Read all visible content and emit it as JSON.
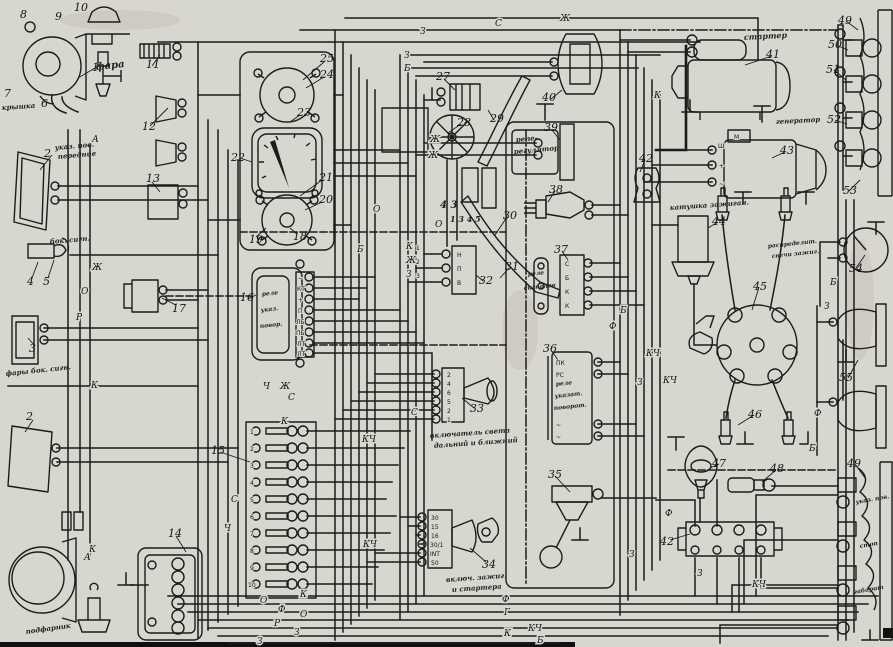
{
  "palette": {
    "paper": "#d7d6cf",
    "ink": "#1c1c1c"
  },
  "num": {
    "n1": "1",
    "n2": "2",
    "n3": "3",
    "n4": "4",
    "n5": "5",
    "n6": "6",
    "n7": "7",
    "n8": "8",
    "n9": "9",
    "n10": "10",
    "n11": "11",
    "n12": "12",
    "n13": "13",
    "n14": "14",
    "n15": "15",
    "n16": "16",
    "n17": "17",
    "n18": "18",
    "n19": "19",
    "n20": "20",
    "n21": "21",
    "n22": "22",
    "n23": "23",
    "n24": "24",
    "n25": "25",
    "n27": "27",
    "n28": "28",
    "n29": "29",
    "n30": "30",
    "n31": "31",
    "n32": "32",
    "n33": "33",
    "n34": "34",
    "n35": "35",
    "n36": "36",
    "n37": "37",
    "n38": "38",
    "n39": "39",
    "n40": "40",
    "n41": "41",
    "n42": "42",
    "n43": "43",
    "n44": "44",
    "n45": "45",
    "n46": "46",
    "n47": "47",
    "n48": "48",
    "n49": "49",
    "n50": "50",
    "n51": "51",
    "n52": "52",
    "n53": "53",
    "n54": "54",
    "n55": "55"
  },
  "fuse_numbers": [
    "1",
    "2",
    "3",
    "4",
    "5",
    "6",
    "7",
    "8",
    "9",
    "10"
  ],
  "wire_letters": {
    "a": "А",
    "b": "Б",
    "g": "Г",
    "zh": "Ж",
    "z": "З",
    "k": "К",
    "kch": "КЧ",
    "o": "О",
    "p": "П",
    "r": "Р",
    "s": "С",
    "f": "Ф",
    "ch": "Ч"
  },
  "terminals": {
    "t16": [
      "−",
      "КТ",
      "+",
      "П",
      "ЛБ",
      "ПБ",
      "ЛТ",
      "ЛТ"
    ],
    "t32": [
      "Н",
      "П",
      "В"
    ],
    "t33": [
      "2",
      "4",
      "6",
      "5",
      "2",
      "1"
    ],
    "t34": [
      "30",
      "15",
      "16",
      "30/1",
      "INT",
      "50"
    ],
    "t36": [
      "ПК",
      "РС",
      "~",
      "~"
    ],
    "t37": [
      "С",
      "Б",
      "К",
      "К"
    ],
    "t43": [
      "М",
      "Ш",
      "+",
      "~"
    ]
  },
  "annotations": {
    "fara": "фара",
    "kryshka": "крышка",
    "front1": "указ. пов.",
    "front2": "передние",
    "bok_note": "бок. сигн.",
    "bok_lamp": "фары бок. сигн.",
    "rele_ukaz1": "реле",
    "rele_ukaz2": "указ.",
    "rele_ukaz3": "повор.",
    "digits_a": "4 3",
    "digits_b": "1 3 4 5",
    "sw_light1": "включатель света",
    "sw_light2": "дальний и ближний",
    "ign1": "включ. зажиг.",
    "ign2": "и стартера",
    "rele_sign1": "реле",
    "rele_sign2": "сигналов",
    "rele_pov1": "реле",
    "rele_pov2": "указат.",
    "rele_pov3": "поворот.",
    "rele_reg1": "реле-",
    "rele_reg2": "регулятор",
    "starter": "стартер",
    "generator": "генератор",
    "coil": "катушка зажиган.",
    "raspred1": "распределит.",
    "raspred2": "свечи зажиг.",
    "podfarnik": "подфарник",
    "zad1": "указ. пов.",
    "zad2": "стоп",
    "zad3": "габарит"
  }
}
